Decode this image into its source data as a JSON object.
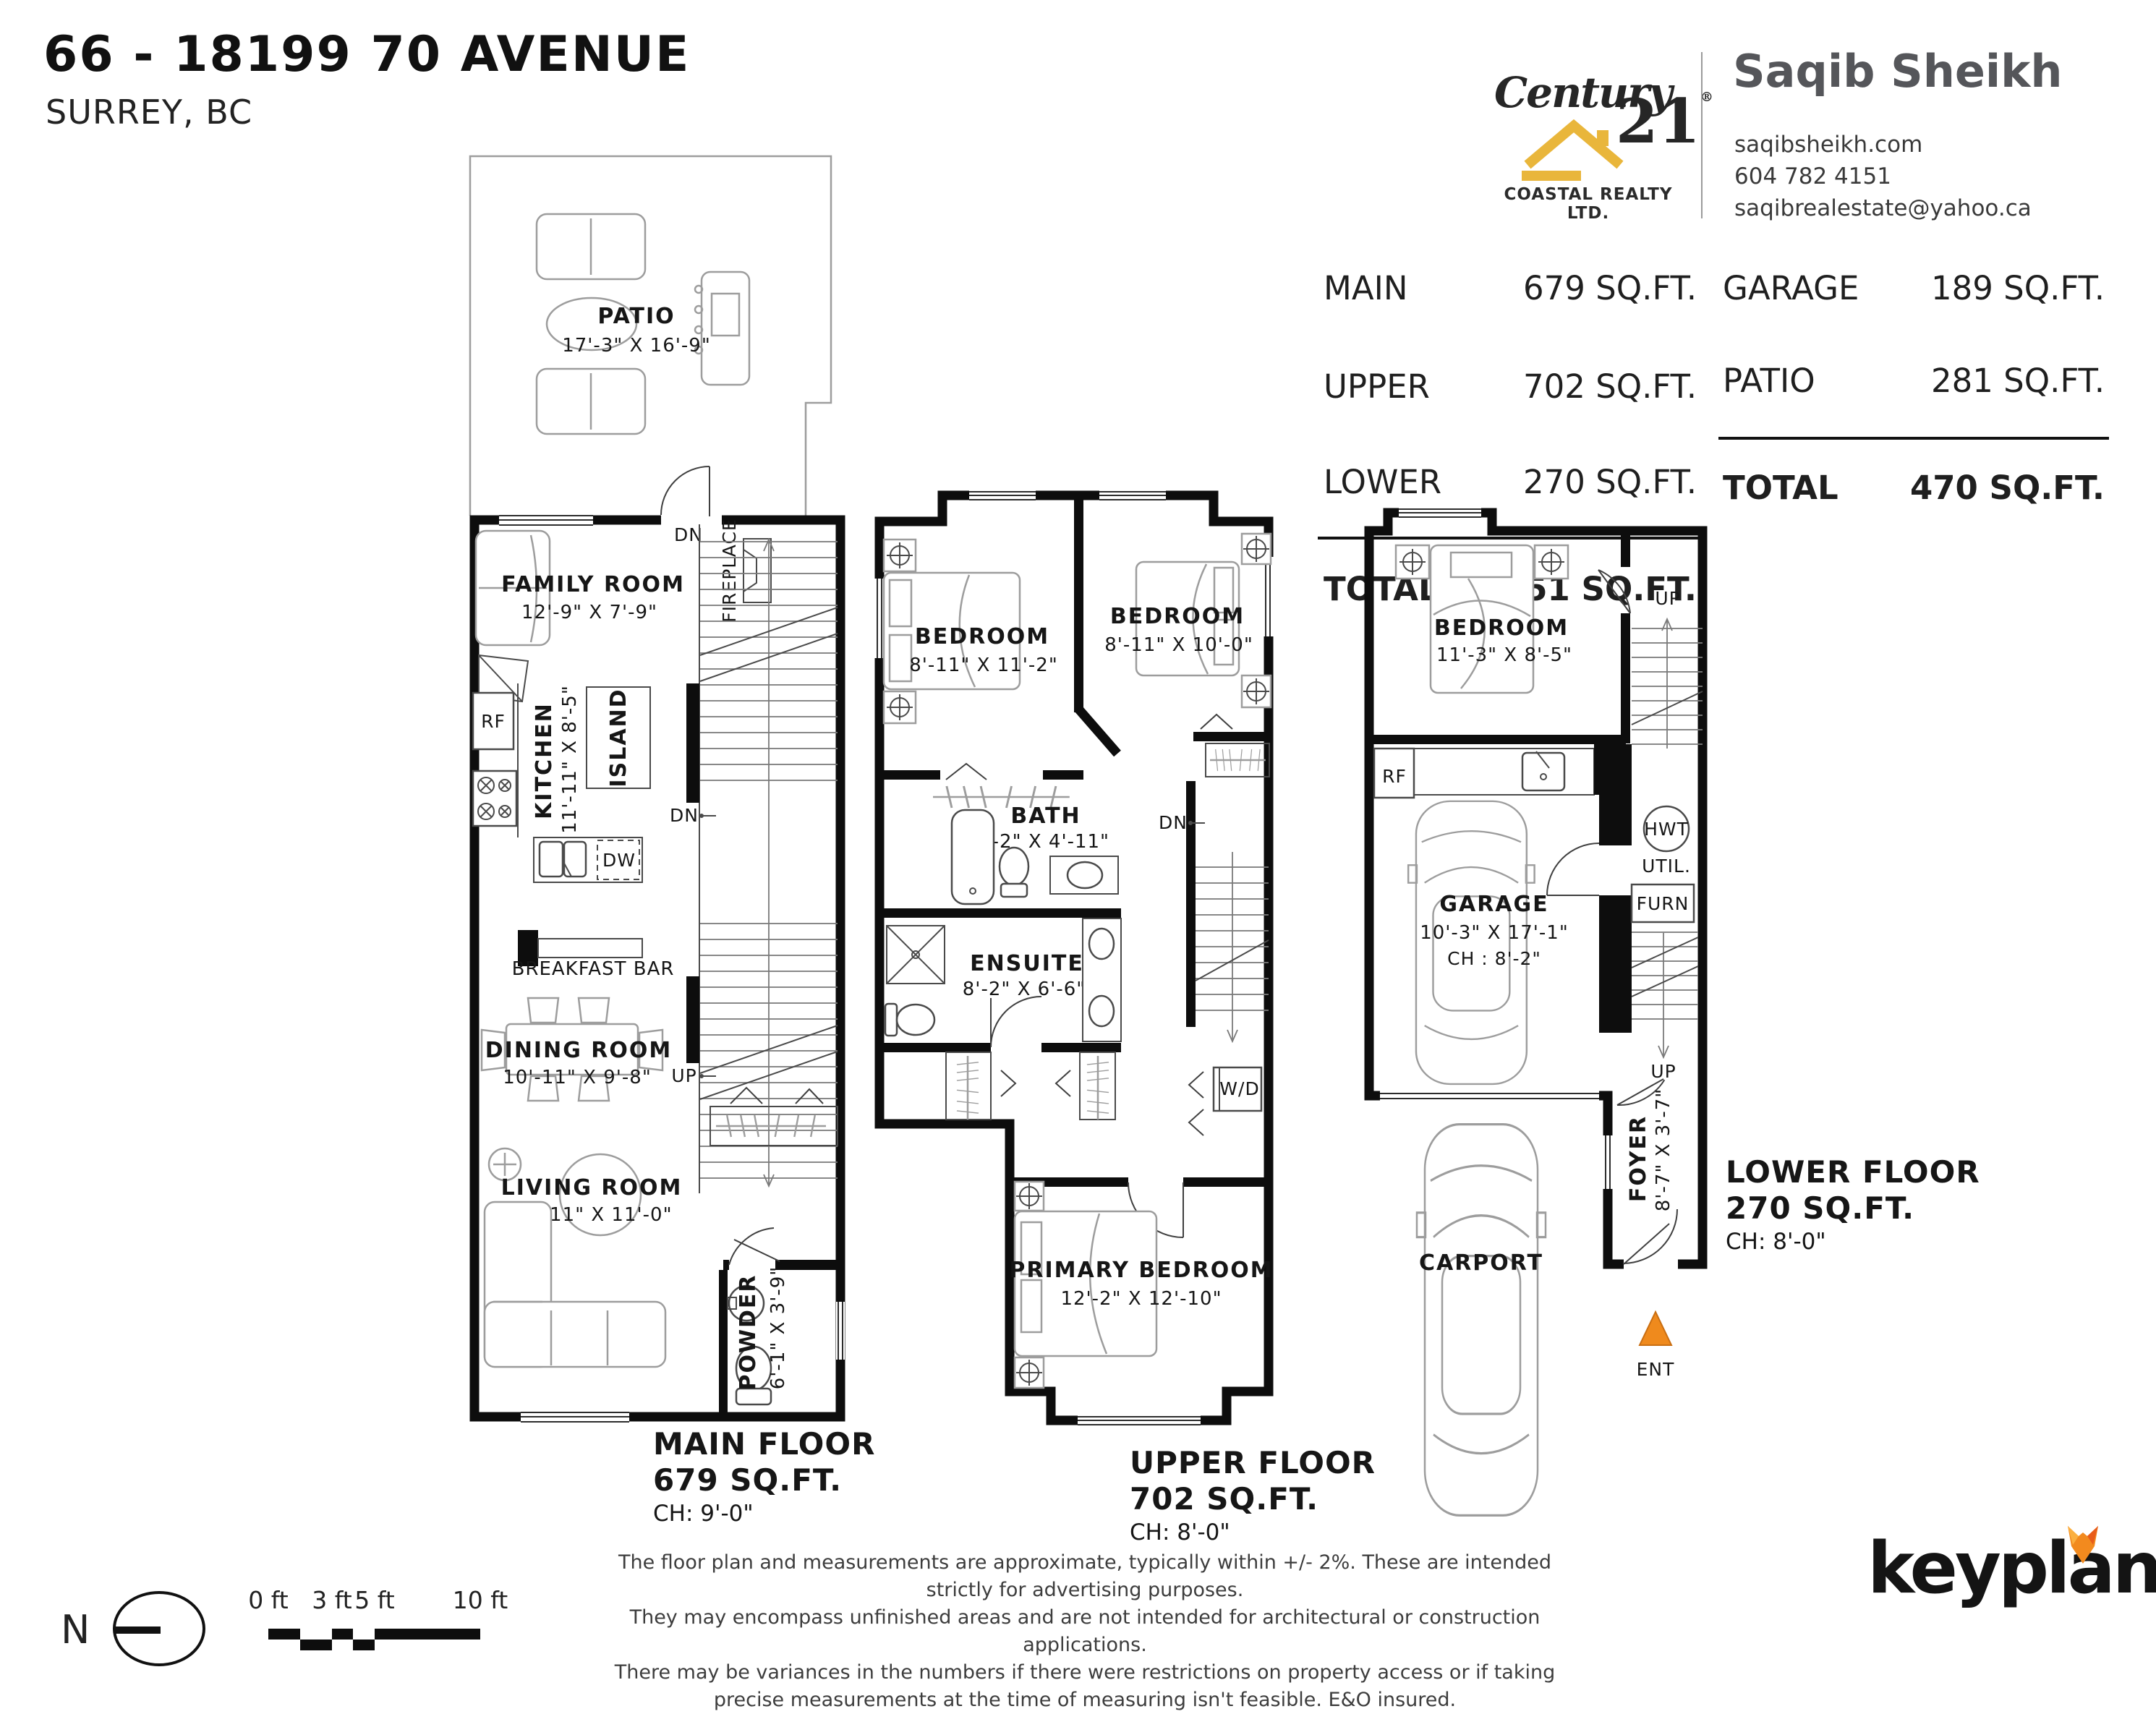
{
  "page": {
    "title": "66 - 18199 70 AVENUE",
    "subtitle": "SURREY, BC"
  },
  "brokerage": {
    "brand_word": "Century",
    "brand_number": "21",
    "brand_reg": "®",
    "brand_sub": "COASTAL REALTY LTD.",
    "gold": "#E9B63B"
  },
  "agent": {
    "name": "Saqib Sheikh",
    "website": "saqibsheikh.com",
    "phone": "604 782 4151",
    "email": "saqibrealestate@yahoo.ca"
  },
  "area_table": {
    "left": {
      "rows": [
        {
          "label": "MAIN",
          "value": "679 SQ.FT."
        },
        {
          "label": "UPPER",
          "value": "702 SQ.FT."
        },
        {
          "label": "LOWER",
          "value": "270 SQ.FT."
        }
      ],
      "total_label": "TOTAL",
      "total_value": "1,651 SQ.FT."
    },
    "right": {
      "rows": [
        {
          "label": "GARAGE",
          "value": "189 SQ.FT."
        },
        {
          "label": "PATIO",
          "value": "281 SQ.FT."
        }
      ],
      "total_label": "TOTAL",
      "total_value": "470 SQ.FT."
    }
  },
  "plans": {
    "main": {
      "patio_label": "PATIO",
      "patio_dims": "17'-3\" X 16'-9\"",
      "dn": "DN",
      "up": "UP",
      "fireplace": "FIREPLACE",
      "family_label": "FAMILY ROOM",
      "family_dims": "12'-9\" X 7'-9\"",
      "rf": "RF",
      "kitchen_label": "KITCHEN",
      "kitchen_dims": "11'-11\" X 8'-5\"",
      "island": "ISLAND",
      "dw": "DW",
      "breakfast_bar": "BREAKFAST BAR",
      "dining_label": "DINING ROOM",
      "dining_dims": "10'-11\" X 9'-8\"",
      "living_label": "LIVING ROOM",
      "living_dims": "10'-11\" X 11'-0\"",
      "powder_label": "POWDER",
      "powder_dims": "6'-1\" X 3'-9\"",
      "title": "MAIN FLOOR",
      "area": "679 SQ.FT.",
      "ceiling": "CH: 9'-0\""
    },
    "upper": {
      "bedroom1_label": "BEDROOM",
      "bedroom1_dims": "8'-11\" X 11'-2\"",
      "bedroom2_label": "BEDROOM",
      "bedroom2_dims": "8'-11\" X 10'-0\"",
      "bath_label": "BATH",
      "bath_dims": "8'-2\" X 4'-11\"",
      "ensuite_label": "ENSUITE",
      "ensuite_dims": "8'-2\" X 6'-6\"",
      "wd": "W/D",
      "dn": "DN",
      "primary_label": "PRIMARY BEDROOM",
      "primary_dims": "12'-2\" X 12'-10\"",
      "title": "UPPER FLOOR",
      "area": "702 SQ.FT.",
      "ceiling": "CH: 8'-0\""
    },
    "lower": {
      "bedroom_label": "BEDROOM",
      "bedroom_dims": "11'-3\" X 8'-5\"",
      "up": "UP",
      "rf": "RF",
      "hwt": "HWT",
      "util": "UTIL.",
      "furn": "FURN",
      "garage_label": "GARAGE",
      "garage_dims": "10'-3\" X 17'-1\"",
      "garage_ceiling": "CH : 8'-2\"",
      "foyer_label": "FOYER",
      "foyer_dims": "8'-7\" X 3'-7\"",
      "carport": "CARPORT",
      "ent": "ENT",
      "title": "LOWER FLOOR",
      "area": "270 SQ.FT.",
      "ceiling": "CH: 8'-0\""
    }
  },
  "footer": {
    "north_letter": "N",
    "scale_labels": [
      "0 ft",
      "3 ft",
      "5 ft",
      "10 ft"
    ],
    "disclaimer": [
      "The floor plan and measurements are approximate, typically within +/- 2%. These are intended strictly for advertising purposes.",
      "They may encompass unfinished areas and are not intended for architectural or construction applications.",
      "There may be variances in the numbers if there were restrictions on property access or if taking precise measurements at the time of measuring isn't feasible. E&O insured."
    ],
    "logo_text": "keyplan"
  },
  "colors": {
    "accent_orange": "#EF8A1D",
    "brand_gold": "#E9B63B",
    "wall_black": "#0D0D0D",
    "agent_gray": "#55565A"
  }
}
